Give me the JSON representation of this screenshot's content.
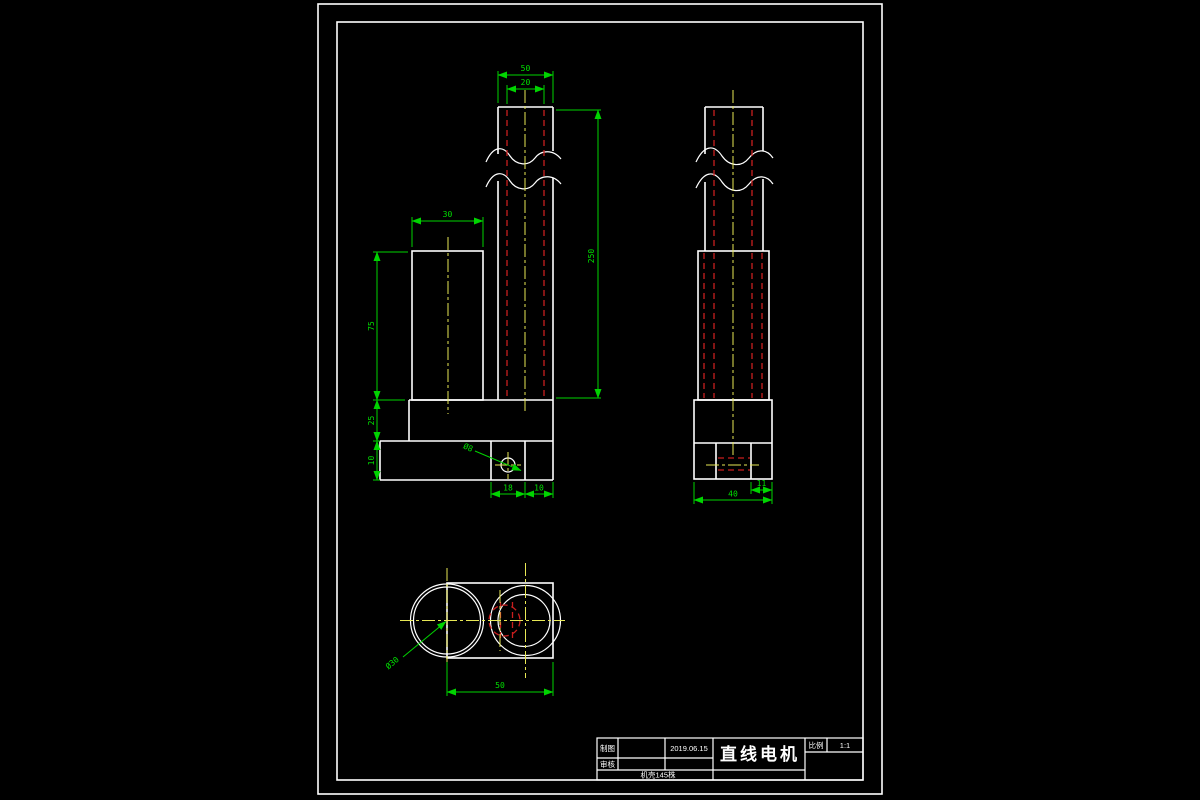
{
  "colors": {
    "background": "#000000",
    "object_lines": "#ffffff",
    "dimension_lines": "#00d400",
    "hidden_lines": "#c81e1e",
    "centerlines": "#e8e855"
  },
  "titleBlock": {
    "drawnLabel": "制图",
    "checkedLabel": "审核",
    "date": "2019.06.15",
    "partTitle": "直线电机",
    "scaleLabel": "比例",
    "scaleValue": "1:1",
    "note": "机壳145株"
  },
  "frontView": {
    "shaftWidth": "50",
    "shaftBore": "20",
    "bodyWidth": "30",
    "bodyHeight": "75",
    "flangeHeight": "25",
    "baseThickness": "10",
    "holeOffsetA": "18",
    "holeOffsetB": "10",
    "shaftLength": "250",
    "holeDia": "Ø8"
  },
  "sideView": {
    "holeInset": "11",
    "baseWidth": "40"
  },
  "bottomView": {
    "boreDia": "Ø30",
    "width": "50"
  }
}
